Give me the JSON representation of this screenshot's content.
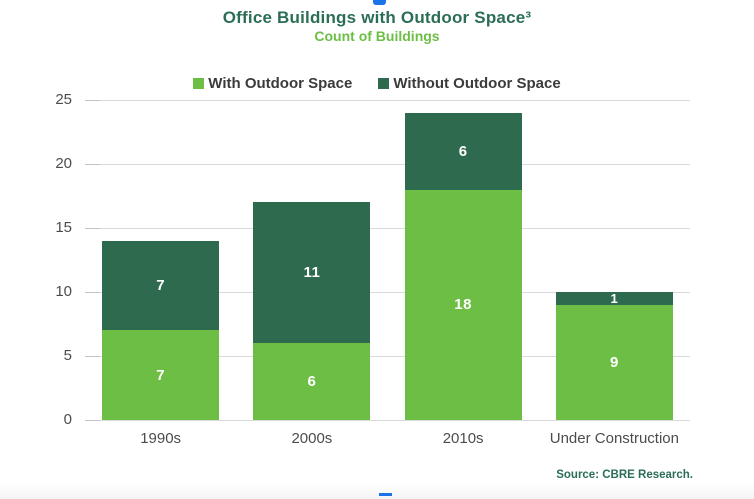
{
  "header": {
    "title": "Office Buildings with Outdoor Space³",
    "subtitle": "Count of Buildings"
  },
  "legend": {
    "items": [
      {
        "label": "With Outdoor Space",
        "color": "#6CBE45"
      },
      {
        "label": "Without Outdoor Space",
        "color": "#2E6B4E"
      }
    ]
  },
  "chart_data": {
    "type": "bar",
    "stacked": true,
    "title": "Office Buildings with Outdoor Space³",
    "subtitle": "Count of Buildings",
    "categories": [
      "1990s",
      "2000s",
      "2010s",
      "Under Construction"
    ],
    "series": [
      {
        "name": "With Outdoor Space",
        "color": "#6CBE45",
        "values": [
          7,
          6,
          18,
          9
        ]
      },
      {
        "name": "Without Outdoor Space",
        "color": "#2E6B4E",
        "values": [
          7,
          11,
          6,
          1
        ]
      }
    ],
    "totals": [
      14,
      17,
      24,
      10
    ],
    "xlabel": "",
    "ylabel": "",
    "ylim": [
      0,
      25
    ],
    "yticks": [
      0,
      5,
      10,
      15,
      20,
      25
    ],
    "grid": true,
    "legend_position": "top",
    "value_labels": "white bold, centered inside each segment"
  },
  "footer": {
    "source": "Source: CBRE Research."
  },
  "colors": {
    "light_green": "#6CBE45",
    "dark_green": "#2E6B4E",
    "title_green": "#2C6E55",
    "axis_text": "#4C4C4C",
    "legend_text": "#3B3B3B",
    "gridline": "#D9D9D9",
    "selection_handle_blue": "#1A73E8"
  }
}
